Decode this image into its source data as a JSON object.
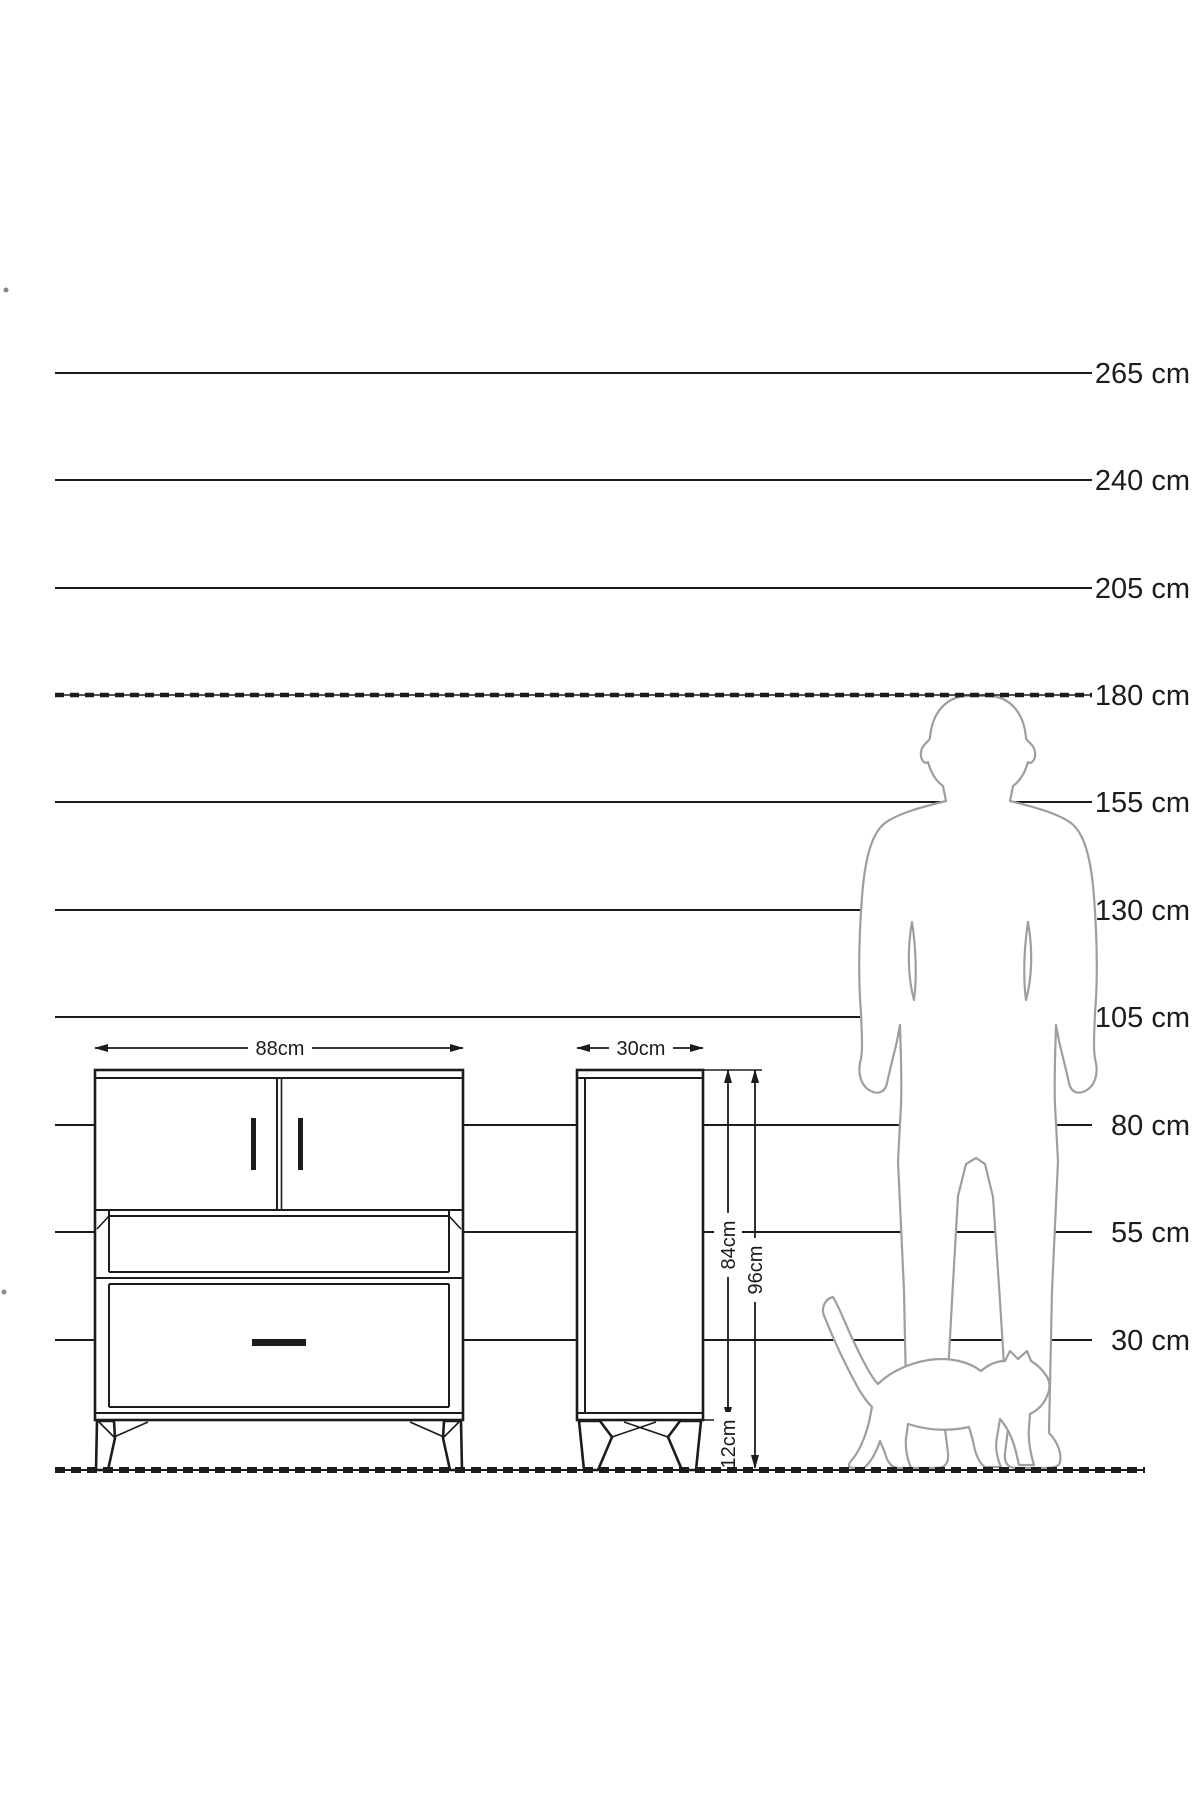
{
  "diagram_title": "furniture-size-comparison-diagram",
  "colors": {
    "ink": "#1c1c1c",
    "figure_outline": "#9e9e9e",
    "background": "#ffffff"
  },
  "ruler": {
    "unit": "cm",
    "line_x_start": 55,
    "line_x_end": 1092,
    "label_x": 1190,
    "lines": [
      {
        "label": "265 cm",
        "y": 373,
        "dashed": false
      },
      {
        "label": "240 cm",
        "y": 480,
        "dashed": false
      },
      {
        "label": "205 cm",
        "y": 588,
        "dashed": false
      },
      {
        "label": "180 cm",
        "y": 695,
        "dashed": true
      },
      {
        "label": "155 cm",
        "y": 802,
        "dashed": false
      },
      {
        "label": "130 cm",
        "y": 910,
        "dashed": false
      },
      {
        "label": "105 cm",
        "y": 1017,
        "dashed": false
      },
      {
        "label": "80 cm",
        "y": 1125,
        "dashed": false
      },
      {
        "label": "55 cm",
        "y": 1232,
        "dashed": false
      },
      {
        "label": "30 cm",
        "y": 1340,
        "dashed": false
      }
    ],
    "ground_y": 1470
  },
  "furniture": {
    "front_view": {
      "width_label": "88cm"
    },
    "side_view": {
      "depth_label": "30cm"
    },
    "heights": {
      "carcass_label": "84cm",
      "total_label": "96cm",
      "leg_label": "12cm"
    }
  },
  "figures": {
    "man": "man-silhouette-180cm",
    "cat": "walking-cat-silhouette"
  }
}
